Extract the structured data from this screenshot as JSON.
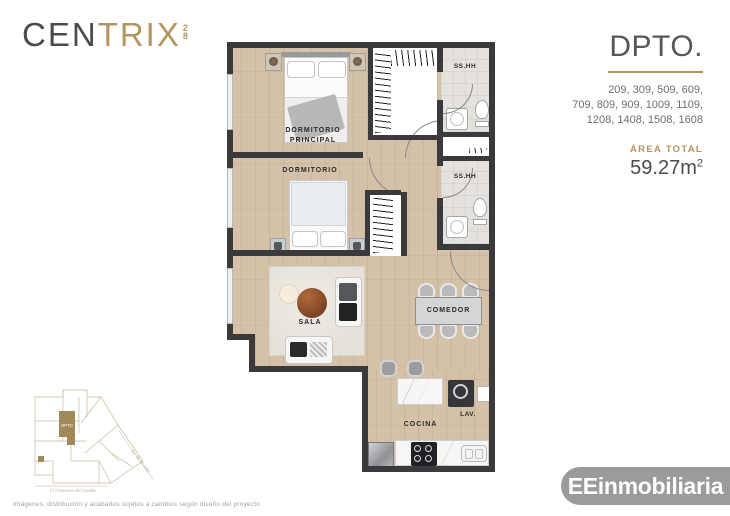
{
  "colors": {
    "accent_gold": "#b5945f",
    "wall_dark": "#3a3a3c",
    "wood_floor": "#d5c0a8",
    "bath_floor": "#e5e2de",
    "brand_gray": "#9b9b9b"
  },
  "brand": {
    "prefix": "CEN",
    "suffix": "TRIX",
    "sup_digit": "2",
    "sub_digit": "8"
  },
  "header": {
    "title": "DPTO.",
    "units_lines": [
      "209, 309, 509, 609,",
      "709, 809, 909, 1009, 1109,",
      "1208, 1408, 1508, 1608"
    ],
    "area_label": "ÁREA TOTAL",
    "area_value": "59.27m",
    "area_exponent": "2"
  },
  "plan": {
    "labels": {
      "master_line1": "DORMITORIO",
      "master_line2": "PRINCIPAL",
      "bedroom": "DORMITORIO",
      "living": "SALA",
      "dining": "COMEDOR",
      "kitchen": "COCINA",
      "laundry": "LAV.",
      "bathroom1": "SS.HH",
      "bathroom2": "SS.HH"
    }
  },
  "minimap": {
    "unit_label": "DPTO",
    "street_bottom": "C/ Francisco del Castillo",
    "street_right": "Av. 28 de Julio"
  },
  "footer": {
    "disclaimer": "Imágenes, distribución y acabados sujetos a cambios según diseño del proyecto",
    "company": "EEinmobiliaria"
  }
}
